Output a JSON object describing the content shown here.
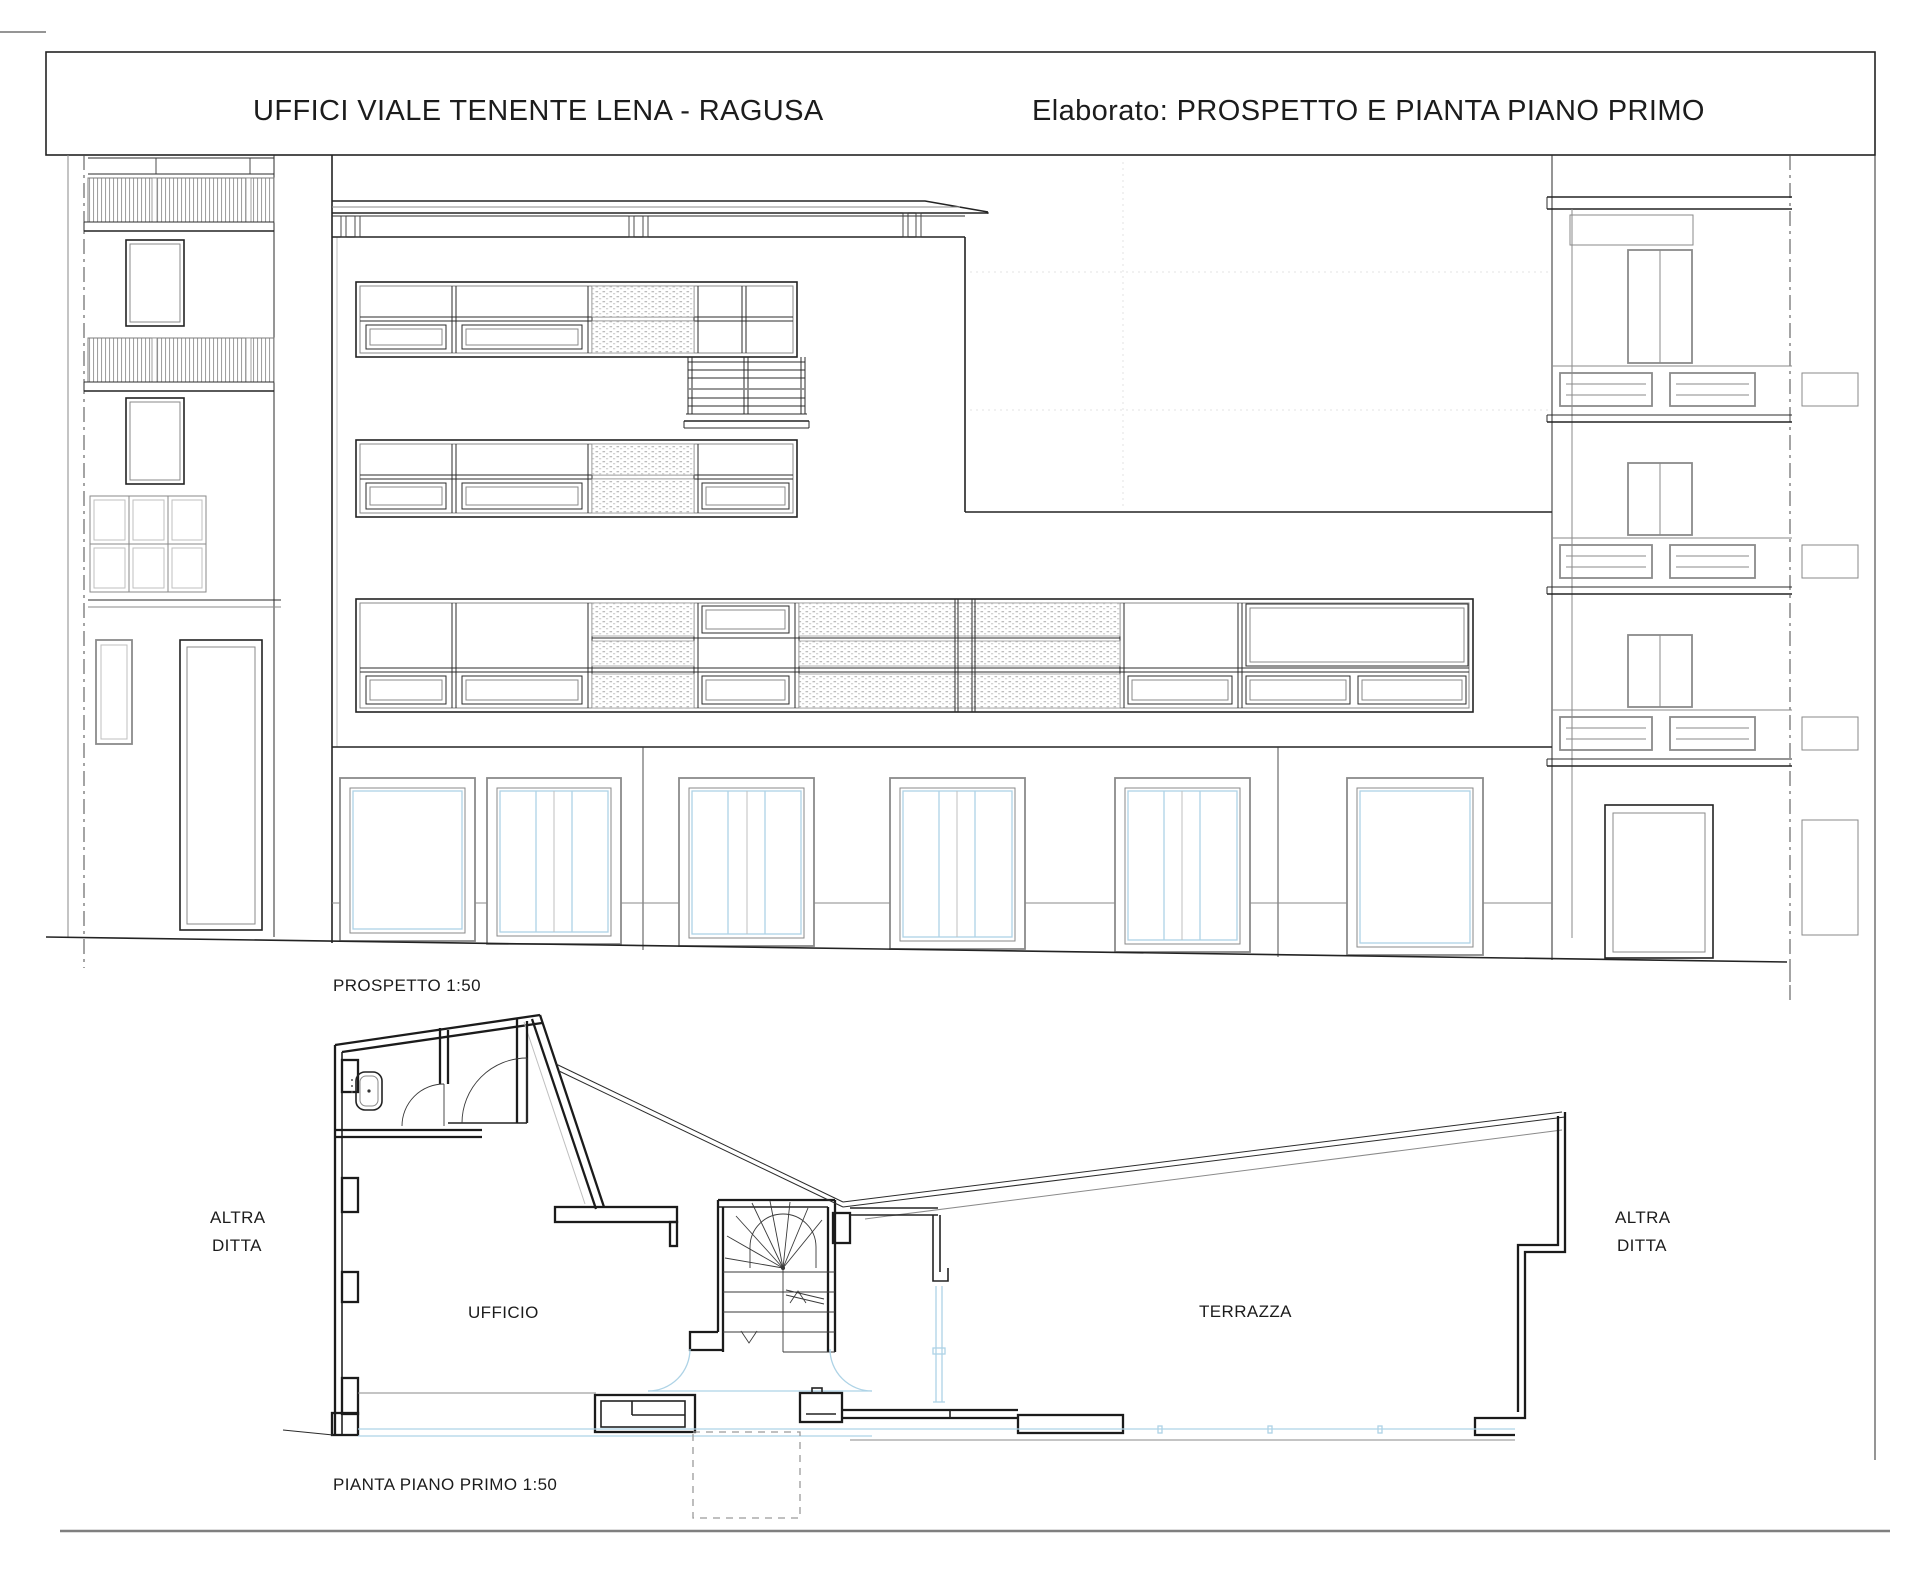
{
  "title_block": {
    "project_title": "UFFICI VIALE TENENTE LENA - RAGUSA",
    "elaborato": "Elaborato: PROSPETTO E PIANTA PIANO PRIMO"
  },
  "elevation": {
    "caption": "PROSPETTO 1:50",
    "scale": "1:50"
  },
  "plan": {
    "caption": "PIANTA PIANO PRIMO  1:50",
    "scale": "1:50",
    "rooms": {
      "office": "UFFICIO",
      "terrace": "TERRAZZA"
    },
    "adjacent_left": {
      "line1": "ALTRA",
      "line2": "DITTA"
    },
    "adjacent_right": {
      "line1": "ALTRA",
      "line2": "DITTA"
    }
  },
  "colors": {
    "line": "#2b2b2b",
    "glazing_blue": "#aed3e6",
    "frame_gray": "#8a8a8a",
    "hatch_gray": "#bdbdbd"
  }
}
